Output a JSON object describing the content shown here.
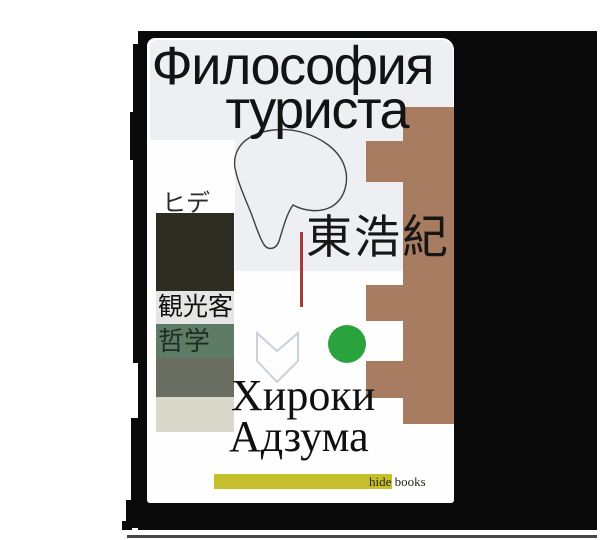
{
  "book": {
    "title_line1": "Философия",
    "title_line2": "туриста",
    "title_full": "Философия туриста",
    "author_japanese": "東浩紀",
    "author_line1": "Хироки",
    "author_line2": "Адзума",
    "side_labels": {
      "katakana": "ヒデ",
      "kanji_tourist": "観光客",
      "kanji_philosophy": "哲学"
    },
    "publisher_label": "hide books",
    "colors": {
      "page_background": "#ffffff",
      "shadow_black": "#0a0a0a",
      "cover_base": "#fefefe",
      "cover_top_panel": "#edeff2",
      "brown_blocks": "#a87c60",
      "dark_olive_block": "#2e2d23",
      "light_label_bar": "#e5e6e3",
      "green_label_bar": "#5e7b66",
      "gray_bar": "#696d62",
      "beige_bar": "#dad7cb",
      "green_dot": "#2aa33c",
      "yellow_bar": "#c6bf2c",
      "red_line": "#a63c34",
      "chevron_fill": "#fdfdfe",
      "chevron_stroke": "#c9d2da"
    }
  }
}
